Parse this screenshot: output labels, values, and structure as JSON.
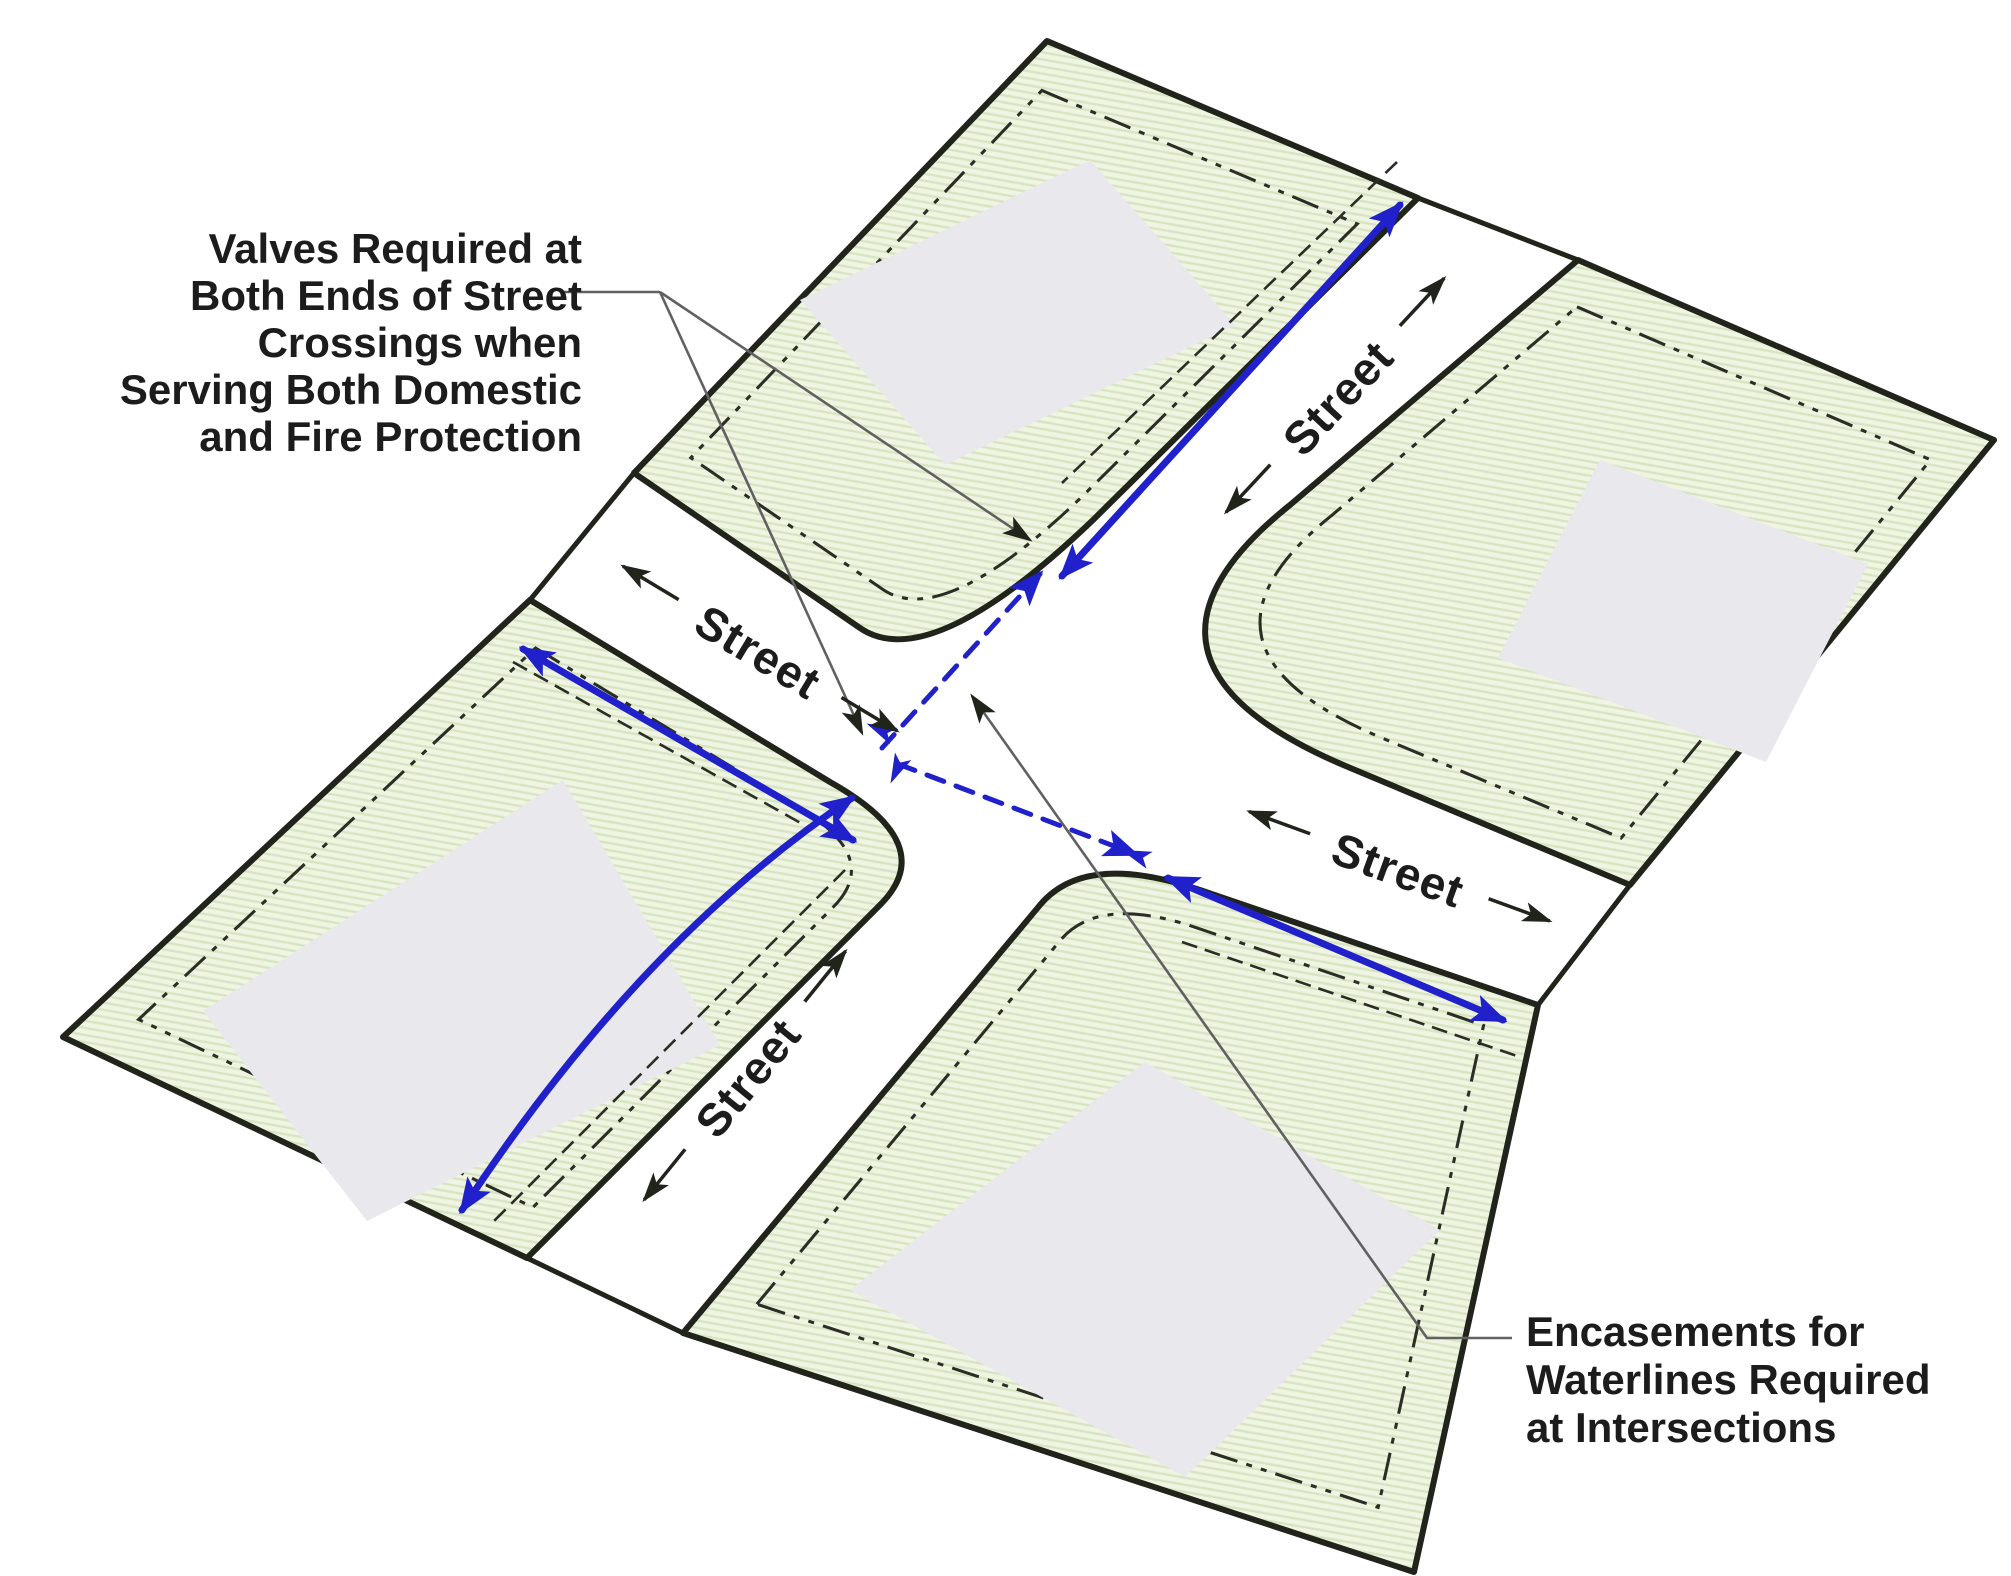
{
  "page": {
    "width": 2011,
    "height": 1576,
    "background": "#ffffff"
  },
  "colors": {
    "waterline_blue": "#2121cc",
    "block_green": "#eff4e3",
    "hatch_green": "#d6e5c0",
    "pad_grey": "#e9e9ed",
    "line_black": "#20241b",
    "leader_grey": "#616161",
    "text_black": "#1c1c1c"
  },
  "street_labels": [
    {
      "text": "Street"
    },
    {
      "text": "Street"
    },
    {
      "text": "Street"
    },
    {
      "text": "Street"
    }
  ],
  "annotations": {
    "valves": {
      "align": "right",
      "lines": [
        "Valves Required at",
        "Both Ends of Street",
        "Crossings when",
        "Serving Both Domestic",
        "and Fire Protection"
      ]
    },
    "encasements": {
      "align": "left",
      "lines": [
        "Encasements for",
        "Waterlines Required",
        "at Intersections"
      ]
    }
  },
  "icons": {
    "waterline_arrow": "solid-triangle-blue",
    "leader_arrow": "solid-triangle-black",
    "street_direction_arrow": "double-headed-arrow",
    "valve_marker": "small-blue-arrowhead-cluster"
  }
}
